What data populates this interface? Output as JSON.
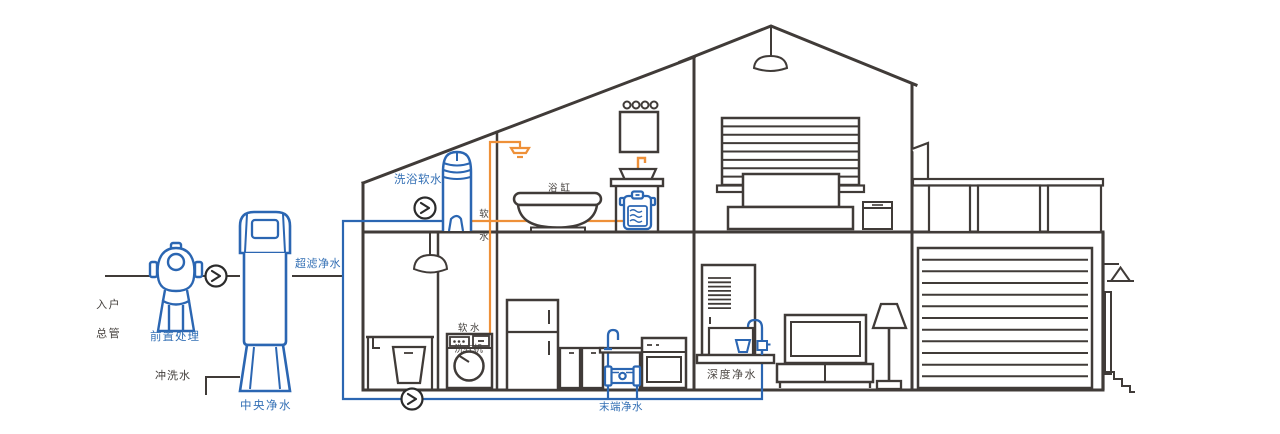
{
  "diagram": {
    "kind": "house-water-purification-system",
    "colors": {
      "line_dark": "#403b38",
      "pipe_blue": "#2b66b2",
      "pipe_orange": "#ee9038",
      "label_blue": "#3470b5",
      "label_dark": "#44403d"
    },
    "labels": {
      "inlet_main": {
        "lines": [
          "入户",
          "总管"
        ]
      },
      "pre_treatment": {
        "text": "前置处理"
      },
      "central_purifier": {
        "text": "中央净水"
      },
      "flush_water": {
        "text": "冲洗水"
      },
      "ultrafiltration": {
        "text": "超滤净水"
      },
      "bath_softener": {
        "text": "洗浴软水"
      },
      "soft_water": {
        "lines": [
          "软",
          "水"
        ]
      },
      "bathtub": {
        "text": "浴缸"
      },
      "soft_water_washer": {
        "lines": [
          "软 水",
          "洗衣机"
        ]
      },
      "terminal_purifier": {
        "text": "末端净水"
      },
      "deep_purifier": {
        "text": "深度净水"
      }
    },
    "flow_indicators": 3
  }
}
